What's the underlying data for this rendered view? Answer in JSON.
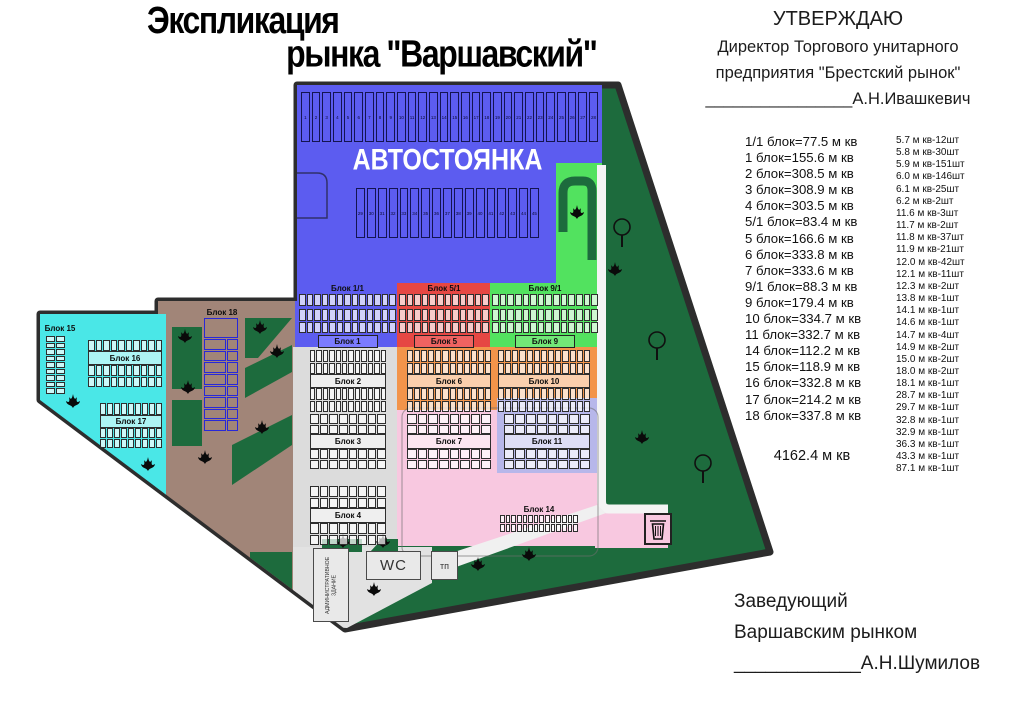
{
  "title": {
    "line1": "Экспликация",
    "line2": "рынка \"Варшавский\""
  },
  "approval": {
    "heading": "УТВЕРЖДАЮ",
    "line1": "Директор Торгового унитарного",
    "line2": "предприятия \"Брестский рынок\"",
    "signature": "________________А.Н.Ивашкевич"
  },
  "manager": {
    "line1": "Заведующий",
    "line2": "Варшавским рынком",
    "signature": "____________А.Н.Шумилов"
  },
  "block_areas": {
    "lines": [
      "1/1 блок=77.5 м кв",
      "1 блок=155.6 м кв",
      "2 блок=308.5 м кв",
      "3 блок=308.9 м кв",
      "4 блок=303.5 м кв",
      "5/1 блок=83.4 м кв",
      "5 блок=166.6 м кв",
      "6 блок=333.8 м кв",
      "7 блок=333.6 м кв",
      "9/1 блок=88.3 м кв",
      "9 блок=179.4 м кв",
      "10 блок=334.7 м кв",
      "11 блок=332.7 м кв",
      "14 блок=112.2 м кв",
      "15 блок=118.9 м кв",
      "16 блок=332.8 м кв",
      "17 блок=214.2 м кв",
      "18 блок=337.8 м кв"
    ],
    "total": "4162.4 м кв"
  },
  "stall_sizes": [
    "5.7 м кв-12шт",
    "5.8 м кв-30шт",
    "5.9 м кв-151шт",
    "6.0 м кв-146шт",
    "6.1 м кв-25шт",
    "6.2 м кв-2шт",
    "11.6 м кв-3шт",
    "11.7 м кв-2шт",
    "11.8 м кв-37шт",
    "11.9 м кв-21шт",
    "12.0 м кв-42шт",
    "12.1 м кв-11шт",
    "12.3 м кв-2шт",
    "13.8 м кв-1шт",
    "14.1 м кв-1шт",
    "14.6 м кв-1шт",
    "14.7 м кв-4шт",
    "14.9 м кв-2шт",
    "15.0 м кв-2шт",
    "18.0 м кв-2шт",
    "18.1 м кв-1шт",
    "28.7 м кв-1шт",
    "29.7 м кв-1шт",
    "32.8 м кв-1шт",
    "32.9 м кв-1шт",
    "36.3 м кв-1шт",
    "43.3 м кв-1шт",
    "87.1 м кв-1шт"
  ],
  "map": {
    "parking": {
      "label": "АВТОСТОЯНКА",
      "rows": [
        {
          "from": 1,
          "to": 28
        },
        {
          "from": 29,
          "to": 45
        }
      ]
    },
    "blocks": {
      "b1_1": "Блок 1/1",
      "b1": "Блок 1",
      "b5_1": "Блок 5/1",
      "b5": "Блок 5",
      "b9_1": "Блок 9/1",
      "b9": "Блок 9",
      "b2": "Блок 2",
      "b3": "Блок 3",
      "b4": "Блок 4",
      "b6": "Блок 6",
      "b7": "Блок 7",
      "b10": "Блок 10",
      "b11": "Блок 11",
      "b14": "Блок 14",
      "b15": "Блок 15",
      "b16": "Блок 16",
      "b17": "Блок 17",
      "b18": "Блок 18"
    },
    "buildings": {
      "wc": "WC",
      "tp": "тп",
      "admin": "АДМИНИСТРАТИВНОЕ ЗДАНИЕ"
    },
    "colors": {
      "site_green": "#1d6b3d",
      "outline": "#2d2d2d",
      "parking_blue": "#5c5cf0",
      "red": "#e64743",
      "bright_green": "#52e25f",
      "orange": "#f3944a",
      "pink": "#f8c8e0",
      "lavender": "#b7b7ea",
      "cyan": "#4ae7e7",
      "brown": "#a18578",
      "gray": "#dcdcdc",
      "tab_blue": "#7b7bff",
      "tab_red": "#ef6361",
      "tab_green": "#72e878"
    }
  }
}
